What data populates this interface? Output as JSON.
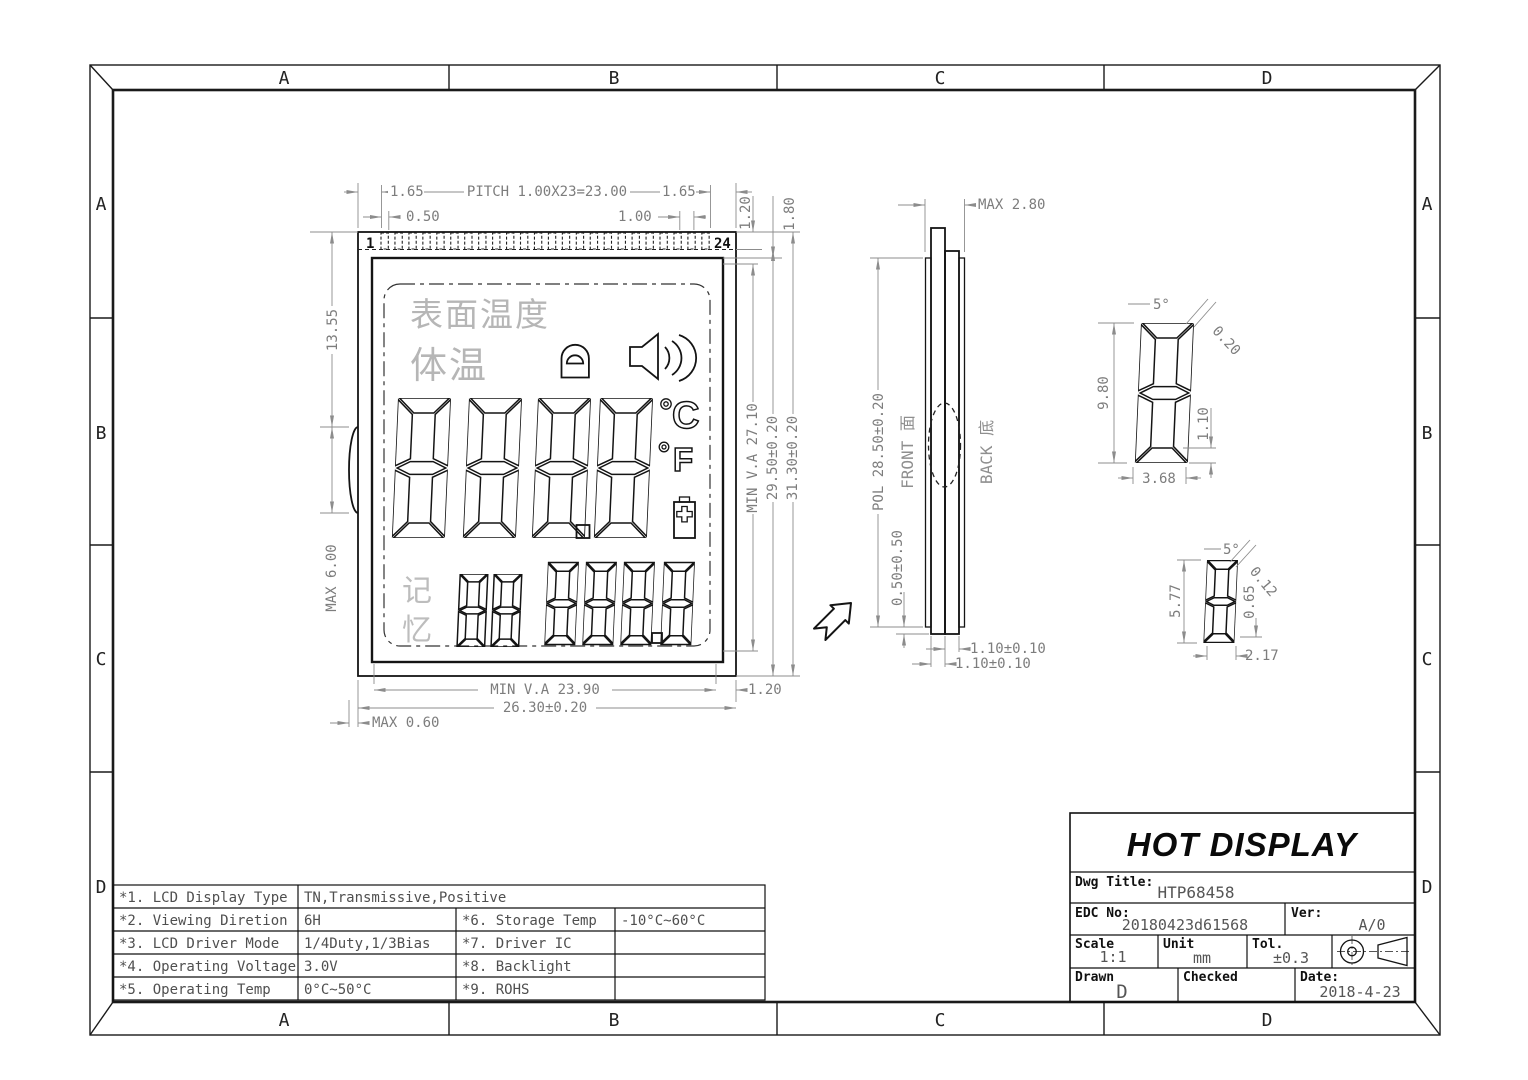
{
  "frame": {
    "zones_top": [
      "A",
      "B",
      "C",
      "D"
    ],
    "zones_bottom": [
      "A",
      "B",
      "C",
      "D"
    ],
    "zones_left": [
      "A",
      "B",
      "C",
      "D"
    ],
    "zones_right": [
      "A",
      "B",
      "C",
      "D"
    ]
  },
  "front_view": {
    "pin_first": "1",
    "pin_last": "24",
    "display": {
      "surface_temp": "表面温度",
      "body_temp": "体温",
      "memory_top": "记",
      "memory_bottom": "忆",
      "celsius": "C",
      "fahrenheit": "F"
    },
    "dims": {
      "pitch": "PITCH 1.00X23=23.00",
      "margin_left": "1.65",
      "margin_right": "1.65",
      "pin_width": "0.50",
      "pin_pitch": "1.00",
      "pin_length": "1.20",
      "seal_offset": "1.80",
      "va_height": "MIN V.A 27.10",
      "lcd_height": "29.50±0.20",
      "total_height": "31.30±0.20",
      "va_width": "MIN V.A 23.90",
      "total_width": "26.30±0.20",
      "edge_gap": "1.20",
      "bump_max": "MAX 0.60",
      "glass_offset": "13.55",
      "bump_span": "MAX 6.00"
    }
  },
  "side_view": {
    "front_label": "FRONT 面",
    "back_label": "BACK 底",
    "dims": {
      "max_thickness": "MAX 2.80",
      "pol_height": "POL 28.50±0.20",
      "pol_inset": "0.50±0.50",
      "back_glass": "1.10±0.10",
      "front_glass": "1.10±0.10"
    }
  },
  "detail_large": {
    "angle": "5°",
    "gap": "0.20",
    "height": "9.80",
    "segment": "1.10",
    "width": "3.68"
  },
  "detail_small": {
    "angle": "5°",
    "gap": "0.12",
    "height": "5.77",
    "segment": "0.65",
    "width": "2.17"
  },
  "title_block": {
    "brand": "HOT DISPLAY",
    "dwg_title_label": "Dwg Title:",
    "dwg_title": "HTP68458",
    "edc_label": "EDC No:",
    "edc_no": "20180423d61568",
    "ver_label": "Ver:",
    "ver": "A/0",
    "scale_label": "Scale",
    "scale": "1:1",
    "unit_label": "Unit",
    "unit": "mm",
    "tol_label": "Tol.",
    "tol": "±0.3",
    "drawn_label": "Drawn",
    "drawn": "D",
    "checked_label": "Checked",
    "date_label": "Date:",
    "date": "2018-4-23"
  },
  "spec_table": {
    "rows": [
      {
        "c1": "*1. LCD Display Type",
        "c2": "TN,Transmissive,Positive",
        "c3": "",
        "c4": ""
      },
      {
        "c1": "*2. Viewing Diretion",
        "c2": "6H",
        "c3": "*6. Storage Temp",
        "c4": "-10°C~60°C"
      },
      {
        "c1": "*3. LCD Driver Mode",
        "c2": "1/4Duty,1/3Bias",
        "c3": "*7. Driver IC",
        "c4": ""
      },
      {
        "c1": "*4. Operating Voltage",
        "c2": "3.0V",
        "c3": "*8. Backlight",
        "c4": ""
      },
      {
        "c1": "*5. Operating Temp",
        "c2": "0°C~50°C",
        "c3": "*9. ROHS",
        "c4": ""
      }
    ]
  },
  "colors": {
    "line": "#141414",
    "dim": "#8c8c8c",
    "ghost_text": "#b6b6b6"
  }
}
